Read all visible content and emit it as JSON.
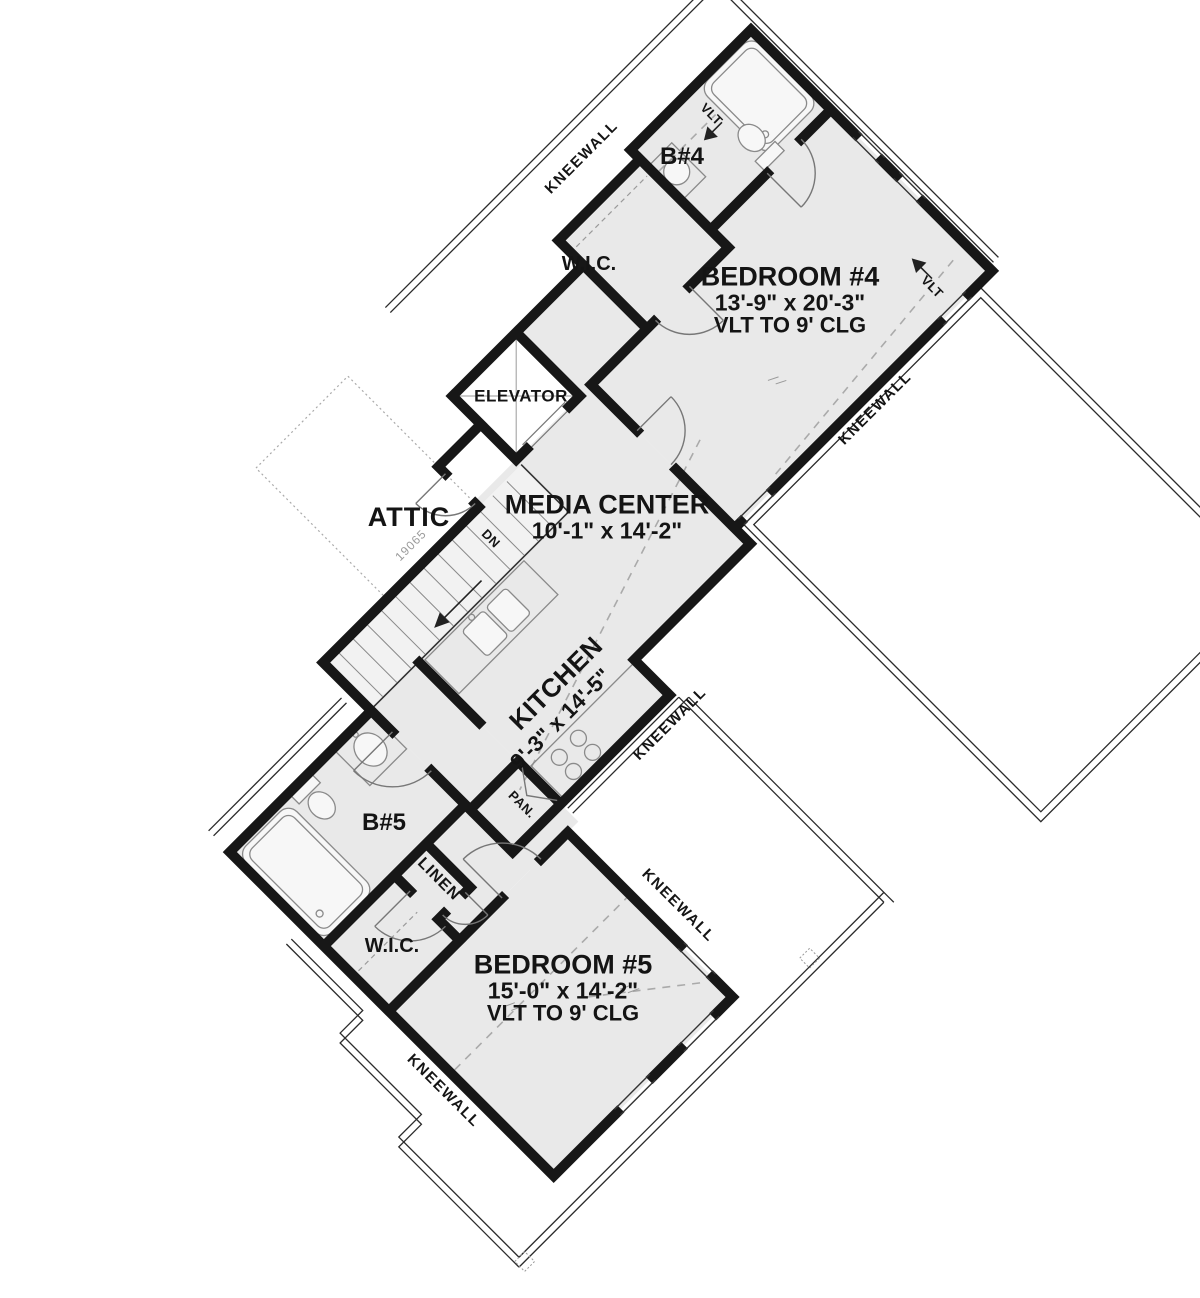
{
  "plan": {
    "rooms": {
      "bedroom4": {
        "name": "BEDROOM #4",
        "dims": "13'-9\" x 20'-3\"",
        "ceiling": "VLT TO 9' CLG"
      },
      "bedroom5": {
        "name": "BEDROOM #5",
        "dims": "15'-0\" x 14'-2\"",
        "ceiling": "VLT TO 9' CLG"
      },
      "media_center": {
        "name": "MEDIA CENTER",
        "dims": "10'-1\" x 14'-2\""
      },
      "kitchen": {
        "name": "KITCHEN",
        "dims": "9'-3\" x 14'-5\""
      },
      "attic": {
        "name": "ATTIC"
      },
      "elevator": {
        "name": "ELEVATOR"
      },
      "bath4": {
        "name": "B#4"
      },
      "bath5": {
        "name": "B#5"
      },
      "wic": {
        "name": "W.I.C."
      },
      "linen": {
        "name": "LINEN"
      },
      "pantry": {
        "name": "PAN."
      }
    },
    "annotations": {
      "kneewall": "KNEEWALL",
      "vlt": "VLT",
      "down": "DN",
      "plan_number": "19065"
    },
    "colors": {
      "floor": "#e9e9e9",
      "wall": "#171717",
      "fixture": "#8a8a8a",
      "dashed": "#aaaaaa",
      "roof": "#2b2b2b",
      "outside": "#ffffff"
    }
  }
}
